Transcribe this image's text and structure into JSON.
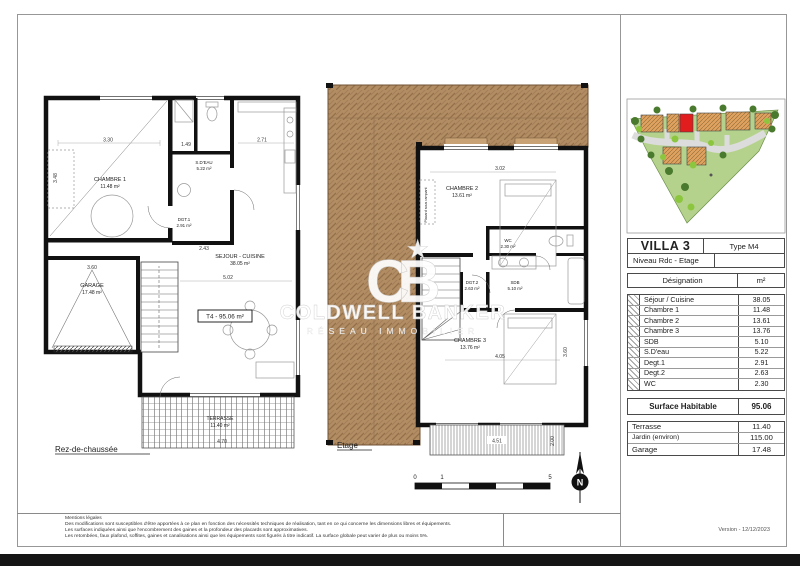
{
  "sheet": {
    "version": "Version  -  12/12/2023"
  },
  "watermark": {
    "logo": "CB",
    "star": "★",
    "line1": "COLDWELL BANKER",
    "line2": "RÉSEAU IMMOBILIER"
  },
  "ground_floor": {
    "title": "Rez-de-chaussée",
    "t4_label": "T4 - 95.06 m²",
    "rooms": {
      "chambre1": {
        "name": "CHAMBRE 1",
        "area": "11.48 m²"
      },
      "sdeau": {
        "name": "S.D'EAU",
        "area": "5.22 m²"
      },
      "degt1": {
        "name": "DGT.1",
        "area": "2.91 m²"
      },
      "sejour": {
        "name": "SEJOUR - CUISINE",
        "area": "38.05 m²"
      },
      "garage": {
        "name": "GARAGE",
        "area": "17.48 m²"
      },
      "terrasse": {
        "name": "TERRASSE",
        "area": "11.40 m²"
      }
    },
    "dims": {
      "d1": "3.30",
      "d2": "3.48",
      "d3": "1.49",
      "d4": "2.71",
      "d5": "2.43",
      "d6": "3.60",
      "d7": "5.02",
      "d8": "4.70"
    }
  },
  "upper_floor": {
    "title": "Etage",
    "rooms": {
      "chambre2": {
        "name": "CHAMBRE 2",
        "area": "13.61 m²"
      },
      "wc": {
        "name": "WC",
        "area": "2.30 m²"
      },
      "degt2": {
        "name": "DGT.2",
        "area": "2.63 m²"
      },
      "sdb": {
        "name": "SDB",
        "area": "5.10 m²"
      },
      "chambre3": {
        "name": "CHAMBRE 3",
        "area": "13.76 m²"
      },
      "placard": {
        "name": "Placard sous rampant"
      }
    },
    "dims": {
      "d1": "3.02",
      "d2": "4.05",
      "d3": "3.60",
      "d4": "4.51",
      "d5": "2.00"
    }
  },
  "scale_bar": {
    "t0": "0",
    "t1": "1",
    "t5": "5"
  },
  "north": {
    "label": "N"
  },
  "table": {
    "title": "VILLA 3",
    "type": "Type M4",
    "level": "Niveau Rdc - Etage",
    "col_designation": "Désignation",
    "col_unit": "m²",
    "rows": [
      {
        "label": "Séjour / Cuisine",
        "value": "38.05"
      },
      {
        "label": "Chambre 1",
        "value": "11.48"
      },
      {
        "label": "Chambre 2",
        "value": "13.61"
      },
      {
        "label": "Chambre 3",
        "value": "13.76"
      },
      {
        "label": "SDB",
        "value": "5.10"
      },
      {
        "label": "S.D'eau",
        "value": "5.22"
      },
      {
        "label": "Degt.1",
        "value": "2.91"
      },
      {
        "label": "Degt.2",
        "value": "2.63"
      },
      {
        "label": "WC",
        "value": "2.30"
      }
    ],
    "total": {
      "label": "Surface Habitable",
      "value": "95.06"
    },
    "extras": [
      {
        "label": "Terrasse",
        "value": "11.40"
      },
      {
        "label": "Jardin (environ)",
        "value": "115.00"
      },
      {
        "label": "Garage",
        "value": "17.48"
      }
    ]
  },
  "footer": {
    "legal_title": "Mentions légales",
    "legal_lines": [
      "Des modifications sont susceptibles d'être apportées à ce plan en fonction des nécessités techniques de réalisation, tant en ce qui concerne les dimensions libres et équipements.",
      "Les surfaces indiquées ainsi que l'encombrement des gaines et la profondeur des placards sont approximatives.",
      "Les retombées, faux plafond, soffites, gaines et canalisations ainsi que les équipements sont figurés à titre indicatif. La surface globale peut varier de plus ou moins 5%."
    ]
  }
}
